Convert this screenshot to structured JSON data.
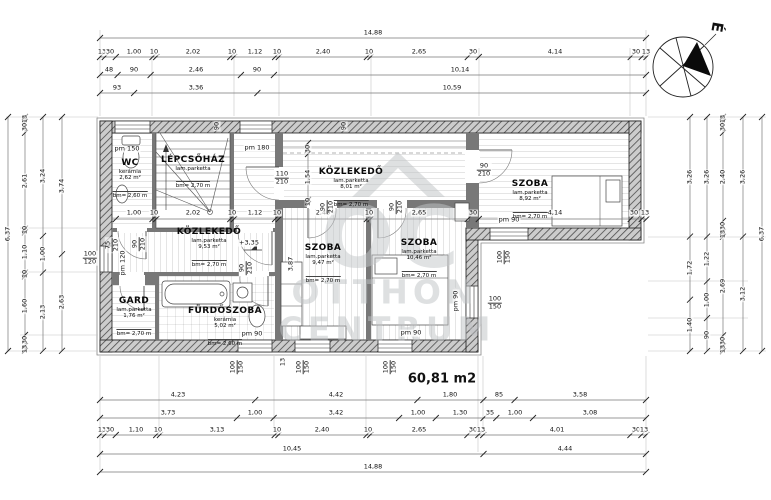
{
  "meta": {
    "total_area": "60,81 m2",
    "compass_label": "É"
  },
  "watermark": {
    "logo": "OC",
    "line1": "OTTHON",
    "line2": "CENTRUM"
  },
  "rooms": [
    {
      "id": "wc",
      "name": "WC",
      "floor": "kerámia",
      "area": "2,62 m²",
      "height": "bm= 2,60 m"
    },
    {
      "id": "lepcsohaz",
      "name": "LÉPCSŐHÁZ",
      "floor": "lam.parketta",
      "area": "",
      "height": "bm= 2,70 m"
    },
    {
      "id": "kozlekedo-felso",
      "name": "KÖZLEKEDŐ",
      "floor": "lam.parketta",
      "area": "8,01 m²",
      "height": "bm= 2,70 m"
    },
    {
      "id": "szoba-jobb",
      "name": "SZOBA",
      "floor": "lam.parketta",
      "area": "8,92 m²",
      "height": "bm= 2,70 m"
    },
    {
      "id": "kozlekedo-also",
      "name": "KÖZLEKEDŐ",
      "floor": "lam.parketta",
      "area": "9,53 m²",
      "height": "bm= 2,70 m"
    },
    {
      "id": "gard",
      "name": "GARD",
      "floor": "lam.parketta",
      "area": "1,76 m²",
      "height": "bm= 2,70 m"
    },
    {
      "id": "furdoszoba",
      "name": "FÜRDŐSZOBA",
      "floor": "kerámia",
      "area": "5,02 m²",
      "height": "bm= 2,60 m"
    },
    {
      "id": "szoba-1",
      "name": "SZOBA",
      "floor": "lam.parketta",
      "area": "9,47 m²",
      "height": "bm= 2,70 m"
    },
    {
      "id": "szoba-2",
      "name": "SZOBA",
      "floor": "lam.parketta",
      "area": "10,46 m²",
      "height": "bm= 2,70 m"
    }
  ],
  "dims": {
    "top1": [
      "14,88"
    ],
    "top2": [
      "13",
      "30",
      "1,00",
      "10",
      "2,02",
      "10",
      "1,12",
      "10",
      "2,40",
      "10",
      "2,65",
      "30",
      "4,14",
      "30",
      "13"
    ],
    "top3": [
      "48",
      "90",
      "2,46",
      "90",
      "10,14"
    ],
    "top4": [
      "93",
      "3,36",
      "10,59"
    ],
    "bottom1": [
      "4,23",
      "4,42",
      "1,80",
      "85",
      "3,58"
    ],
    "bottom2": [
      "3,73",
      "1,00",
      "3,42",
      "1,00",
      "1,30",
      "35",
      "1,00",
      "3,08"
    ],
    "bottom3": [
      "13",
      "30",
      "1,10",
      "10",
      "3,13",
      "10",
      "2,40",
      "10",
      "2,65",
      "30",
      "13",
      "4,01",
      "30",
      "13"
    ],
    "bottom4": [
      "10,45",
      "4,44"
    ],
    "bottom5": [
      "14,88"
    ],
    "left1": [
      "6,37"
    ],
    "left2": [
      "13",
      "30",
      "2,61",
      "10",
      "1,10",
      "10",
      "1,60",
      "30",
      "13"
    ],
    "left3": [
      "3,24",
      "1,00",
      "2,13"
    ],
    "left4": [
      "3,74",
      "2,63"
    ],
    "right1": [
      "3,26",
      "1,72",
      "1,40"
    ],
    "right2": [
      "3,26",
      "1,22",
      "1,00",
      "90"
    ],
    "right3": [
      "13",
      "30",
      "2,40",
      "30",
      "13",
      "2,69",
      "30",
      "13"
    ],
    "right4": [
      "3,26",
      "3,12"
    ],
    "right5": [
      "6,37"
    ],
    "inner_h": [
      "1,00",
      "10",
      "2,02",
      "10",
      "1,12",
      "10",
      "2,40",
      "10",
      "2,65",
      "30",
      "4,14",
      "30",
      "13"
    ],
    "inner_v": [
      "30",
      "1,54",
      "10"
    ]
  },
  "annotations": [
    "pm 150",
    "pm 180",
    "90",
    "90",
    "110/210",
    "90/210",
    "pm 90",
    "100/150",
    "100/150",
    "pm 90",
    "90/210",
    "90/210",
    "90/210",
    "75/210",
    "90/210",
    "pm 120",
    "100/120",
    "100/150",
    "13",
    "100/150",
    "100/150",
    "pm 90",
    "pm 90",
    "+3,35",
    "3,87"
  ]
}
